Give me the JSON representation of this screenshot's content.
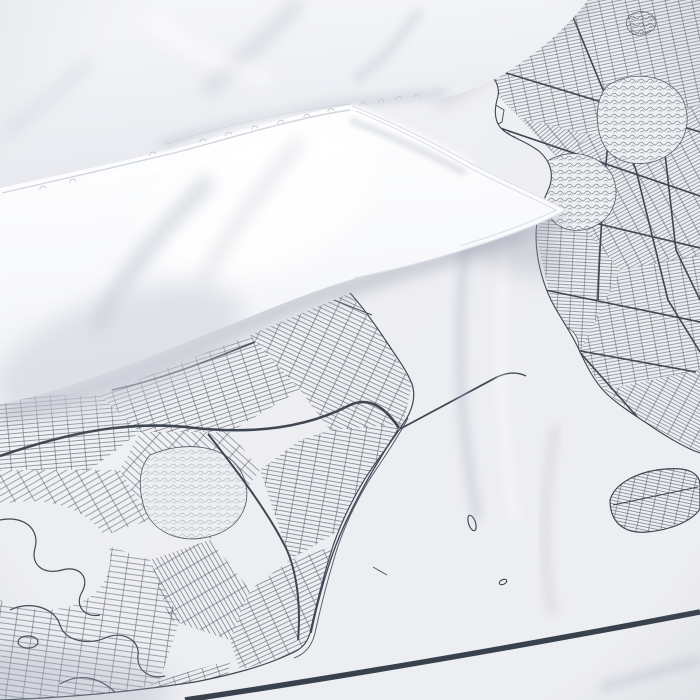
{
  "scene": {
    "type": "product-photograph",
    "subject": "white-bedding-with-city-map-printed-duvet",
    "elements": [
      {
        "name": "pillow-back",
        "description": "soft white pillow fold, upper left"
      },
      {
        "name": "pillow-front",
        "description": "bright white pillow corner pointing right with stitched seam"
      },
      {
        "name": "map-printed-duvet",
        "description": "duvet cover printed with monochrome fine-line street map of a harbor city"
      },
      {
        "name": "water-channel",
        "description": "unprinted fabric area forming the harbor between two landmasses"
      },
      {
        "name": "suspension-bridge-line",
        "description": "thin straight line crossing the narrows between the landmasses"
      },
      {
        "name": "barrier-island",
        "description": "small elongated hatched island at right edge"
      },
      {
        "name": "small-islands",
        "description": "two tiny outlined islands in open water"
      },
      {
        "name": "map-border-line",
        "description": "thick printed frame border crossing the bottom right corner"
      }
    ]
  },
  "palette": {
    "fabric_base": "#edeef2",
    "fabric_light": "#f4f5f8",
    "fabric_shade": "#d9dce3",
    "pillow_white": "#ffffff",
    "pillow_base": "#f6f7fa",
    "pillow_shade": "#c9cdd7",
    "seam_line": "#d2d6de",
    "map_line": "#4a5460",
    "map_line_strong": "#3e4752",
    "border_line": "#39424c",
    "shadow_soft": "#969cac"
  },
  "map_print": {
    "style": "fine parallel street grid, monochrome",
    "features": [
      "dense-street-grid-upper-right-landmass",
      "irregular-street-grid-lower-left-landmass",
      "park-blobs-with-squiggle-texture",
      "pier-comb-shapes-on-waterfront",
      "thick-expressway-lines",
      "winding-streams-lower-left",
      "plain-water-channel",
      "bridge-line",
      "barrier-island-hatched",
      "two-small-islands",
      "thick-frame-border"
    ]
  }
}
